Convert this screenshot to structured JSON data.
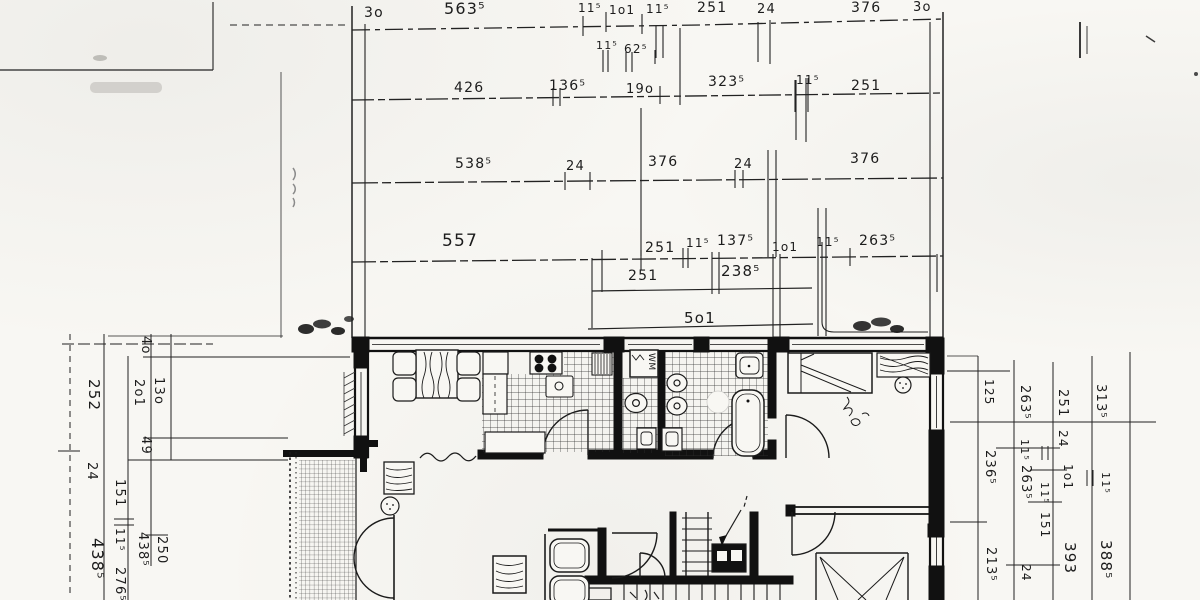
{
  "colors": {
    "ink": "#1b1b1b",
    "paper": "#f8f7f3"
  },
  "dims": {
    "row1": [
      "3o",
      "563⁵",
      "11⁵",
      "1o1",
      "11⁵",
      "251",
      "24",
      "376",
      "3o"
    ],
    "row1_sub": [
      "11⁵",
      "62⁵"
    ],
    "row2": [
      "426",
      "136⁵",
      "19o",
      "323⁵",
      "11⁵",
      "251"
    ],
    "row3": [
      "538⁵",
      "24",
      "376",
      "24",
      "376"
    ],
    "row4": [
      "557",
      "251",
      "11⁵",
      "137⁵",
      "1o1",
      "11⁵",
      "263⁵"
    ],
    "row5": [
      "251",
      "238⁵"
    ],
    "row6": [
      "5o1"
    ],
    "left": [
      "4o",
      "252",
      "2o1",
      "13o",
      "49",
      "24",
      "151",
      "11⁵",
      "438⁵",
      "276⁵",
      "438⁵",
      "250"
    ],
    "right": [
      "125",
      "263⁵",
      "251",
      "313⁵",
      "236⁵",
      "11⁵",
      "24",
      "1o1",
      "263⁵",
      "11⁵",
      "151",
      "11⁵",
      "213⁵",
      "24",
      "393",
      "388⁵"
    ]
  },
  "plan": {
    "washing_machine_label": "WM"
  }
}
